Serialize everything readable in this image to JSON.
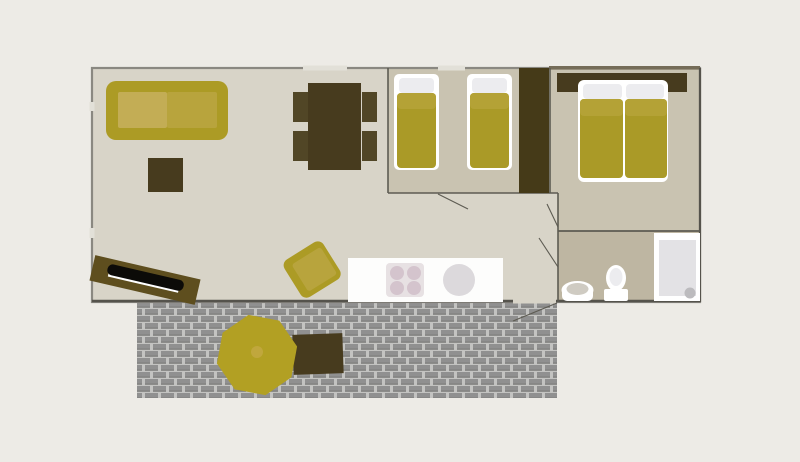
{
  "scene": {
    "type": "floor-plan",
    "rooms": [
      "living-room",
      "dining-area",
      "kitchen",
      "twin-bedroom",
      "double-bedroom",
      "bathroom",
      "deck"
    ],
    "furniture": [
      "sofa",
      "coffee-table",
      "tv",
      "dining-table",
      "four-chairs",
      "armchair",
      "kitchen-counter",
      "stove",
      "kitchen-sink",
      "twin-bed-1",
      "twin-bed-2",
      "wardrobe",
      "double-bed",
      "headboard",
      "bathroom-sink",
      "toilet",
      "shower",
      "parasol",
      "deck-table"
    ]
  },
  "palette": {
    "page_bg": "#edebe6",
    "floor_living": "#d8d4c8",
    "floor_bedroom": "#c9c3b1",
    "floor_bathroom": "#beb6a2",
    "wall_outer": "#8a8881",
    "wall_inner": "#5d5b52",
    "wall_dark": "#55534c",
    "wall_top_dark": "#756c58",
    "window_gap": "#e2e0d8",
    "gold": "#ac9b25",
    "gold_light": "#c3ad55",
    "gold_mid": "#b8a43d",
    "mattress": "#aa9a27",
    "mattress_band": "#b4a236",
    "dark_wood": "#473b1e",
    "chair_wood": "#514626",
    "wardrobe_wood": "#453a18",
    "tv_stand": "#5e4e1e",
    "tv_screen": "#0c0b08",
    "white": "#ffffff",
    "pillow_gray": "#ececef",
    "counter_white": "#fdfdfc",
    "stove_panel": "#e7e1e3",
    "burner": "#d4c4cd",
    "sink_gray": "#dcd9dc",
    "shower_inner": "#e3e2e5",
    "drain_gray": "#bcbbbe",
    "ceramic_inner": "#cfcbc2",
    "deck_bg": "#c3c3c1",
    "deck_plank": "#909090",
    "deck_plank_dark": "#7e7e7c",
    "parasol": "#b2a023",
    "parasol_center": "#c0a73d"
  }
}
